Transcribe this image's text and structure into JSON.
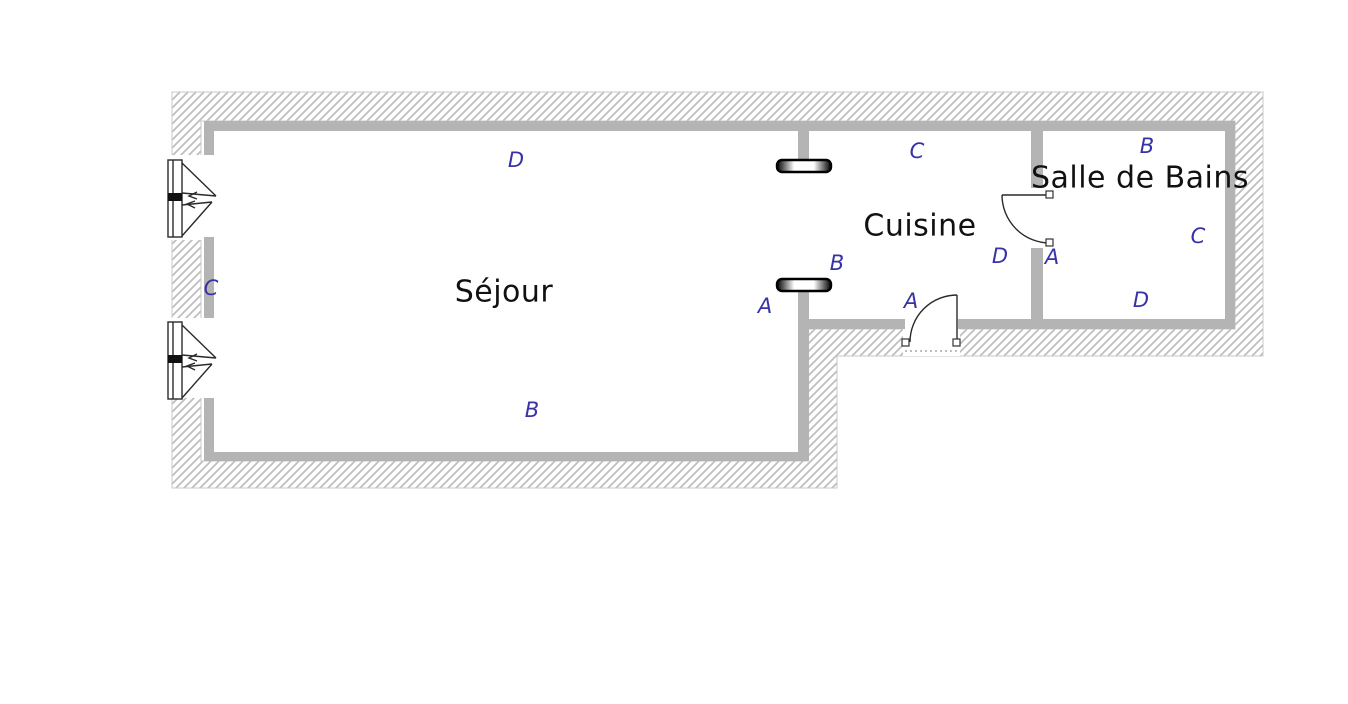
{
  "diagram": {
    "type": "floor-plan",
    "language": "fr"
  },
  "colors": {
    "wall_gray": "#b4b4b4",
    "hatch_gray": "#bdbdbd",
    "outline_gray": "#c9c9c9",
    "marker_blue": "#3733a6",
    "text_black": "#111111",
    "line_dark": "#2a2a2a"
  },
  "rooms": [
    {
      "id": "sejour",
      "name": "Séjour",
      "label_x": 504,
      "label_y": 292
    },
    {
      "id": "cuisine",
      "name": "Cuisine",
      "label_x": 920,
      "label_y": 226
    },
    {
      "id": "salle_de_bains",
      "name": "Salle de Bains",
      "label_x": 1140,
      "label_y": 178
    }
  ],
  "wall_markers": [
    {
      "room": "sejour",
      "text": "D",
      "x": 516,
      "y": 160
    },
    {
      "room": "sejour",
      "text": "C",
      "x": 211,
      "y": 288
    },
    {
      "room": "sejour",
      "text": "B",
      "x": 532,
      "y": 410
    },
    {
      "room": "sejour",
      "text": "A",
      "x": 765,
      "y": 306
    },
    {
      "room": "cuisine",
      "text": "B",
      "x": 837,
      "y": 263
    },
    {
      "room": "cuisine",
      "text": "C",
      "x": 917,
      "y": 151
    },
    {
      "room": "cuisine",
      "text": "A",
      "x": 911,
      "y": 301
    },
    {
      "room": "cuisine",
      "text": "D",
      "x": 1000,
      "y": 256
    },
    {
      "room": "salle_de_bains",
      "text": "A",
      "x": 1052,
      "y": 257
    },
    {
      "room": "salle_de_bains",
      "text": "B",
      "x": 1147,
      "y": 146
    },
    {
      "room": "salle_de_bains",
      "text": "C",
      "x": 1198,
      "y": 236
    },
    {
      "room": "salle_de_bains",
      "text": "D",
      "x": 1141,
      "y": 300
    }
  ],
  "symbols": [
    {
      "name": "casement-window",
      "count": 2,
      "location": "left exterior wall of Séjour"
    },
    {
      "name": "door-swing",
      "count": 2,
      "location": "entrance in south wall of Cuisine; door between Cuisine and Salle de Bains"
    },
    {
      "name": "lintel-bar",
      "count": 2,
      "location": "wide opening between Séjour and Cuisine"
    }
  ]
}
